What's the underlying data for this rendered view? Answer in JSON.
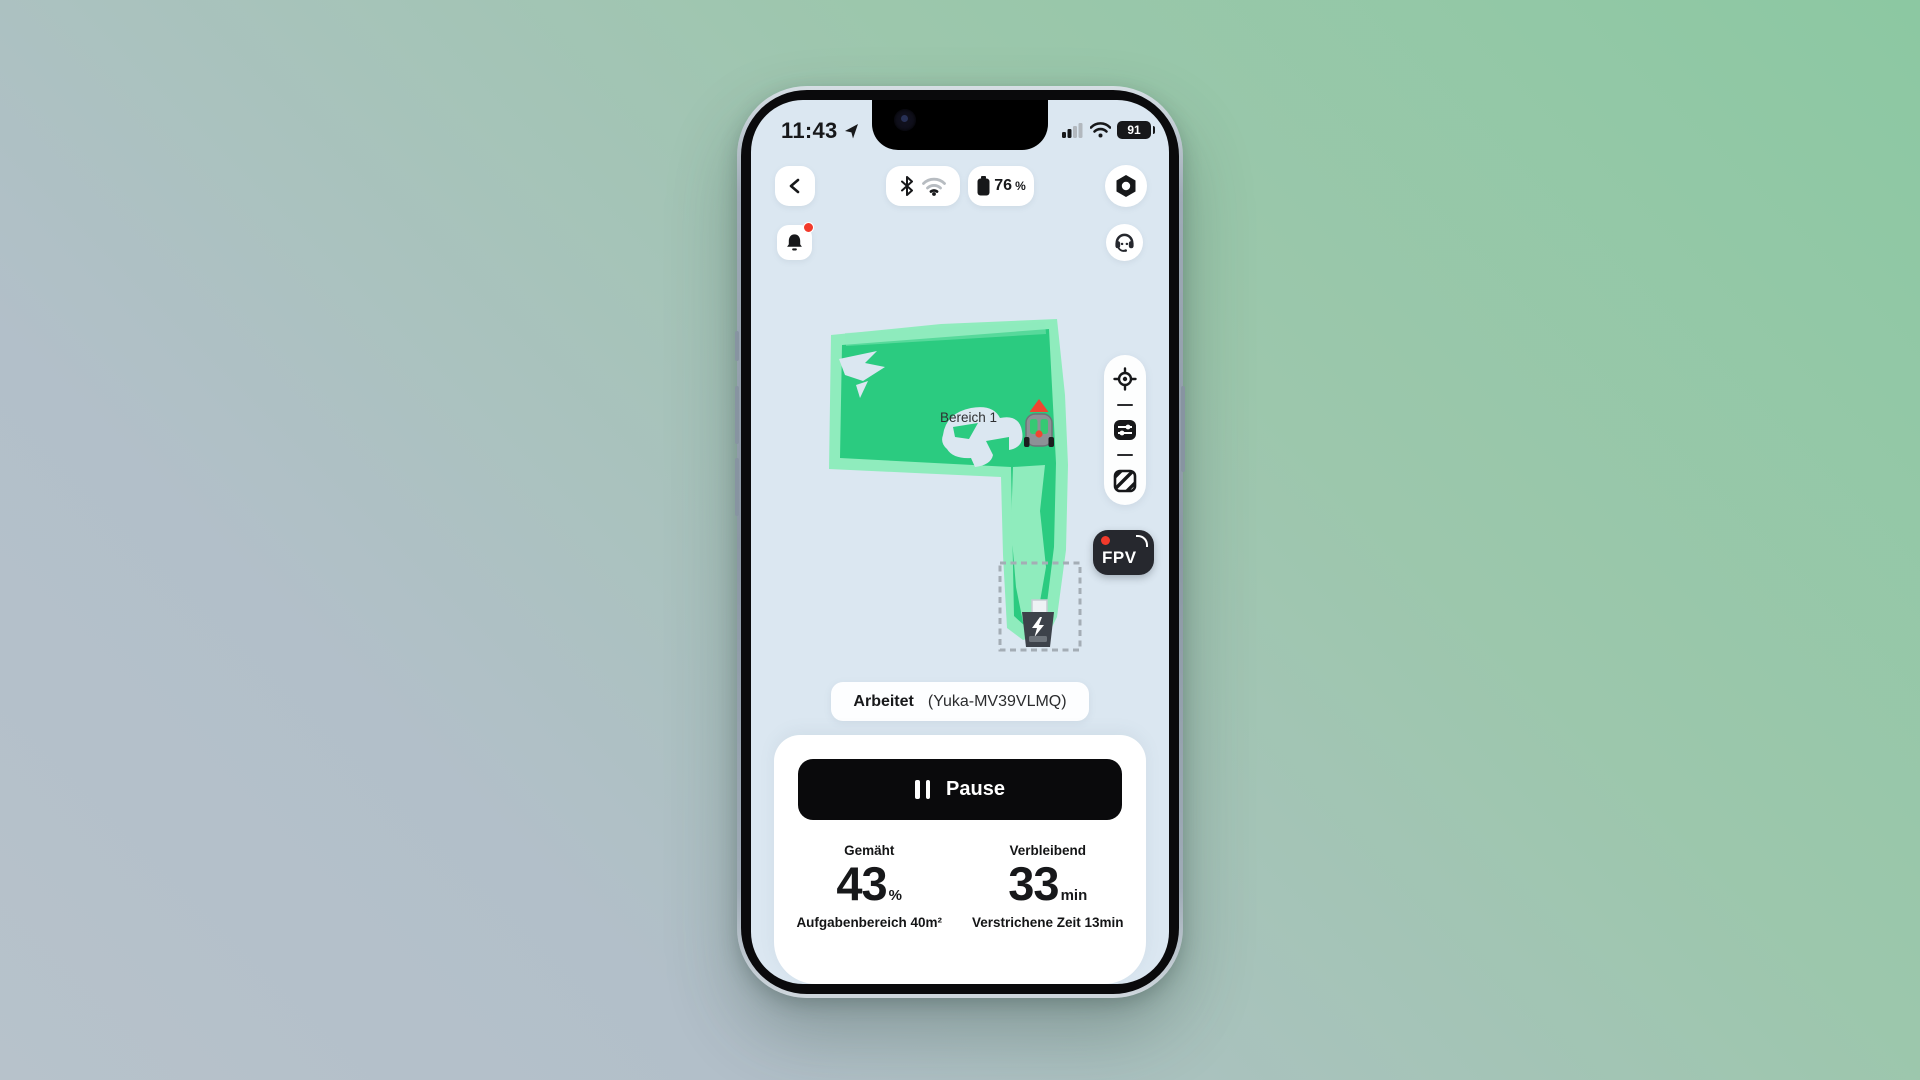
{
  "status_bar": {
    "time": "11:43",
    "phone_battery": "91"
  },
  "header": {
    "device_battery_value": "76",
    "device_battery_unit": "%"
  },
  "icons": {
    "nav": "location-arrow",
    "back": "chevron-left",
    "connectivity": [
      "bluetooth",
      "wifi"
    ],
    "settings": "hexagon-nut",
    "alerts": "bell-with-red-dot",
    "support": "headset",
    "map_tools": [
      "locate-crosshair",
      "sliders",
      "hatched-zone"
    ],
    "dock": "charging-station-lightning",
    "robot": "mower-with-heading-arrow"
  },
  "map": {
    "zone_label": "Bereich 1",
    "fpv_label": "FPV"
  },
  "status_pill": {
    "state": "Arbeitet",
    "device": "(Yuka-MV39VLMQ)"
  },
  "controls": {
    "pause_label": "Pause"
  },
  "stats": {
    "mowed": {
      "label": "Gemäht",
      "value": "43",
      "unit": "%",
      "sub": "Aufgabenbereich 40m²"
    },
    "remaining": {
      "label": "Verbleibend",
      "value": "33",
      "unit": "min",
      "sub": "Verstrichene Zeit 13min"
    }
  },
  "colors": {
    "screen_bg": "#dbe7f1",
    "map_green_light": "#8fecbd",
    "map_green_dark": "#2bcb80",
    "alert_red": "#f23a2b",
    "fpv_bg": "#26282e",
    "bg_gradient": [
      "#8cc8a2",
      "#b7c2cb"
    ]
  }
}
